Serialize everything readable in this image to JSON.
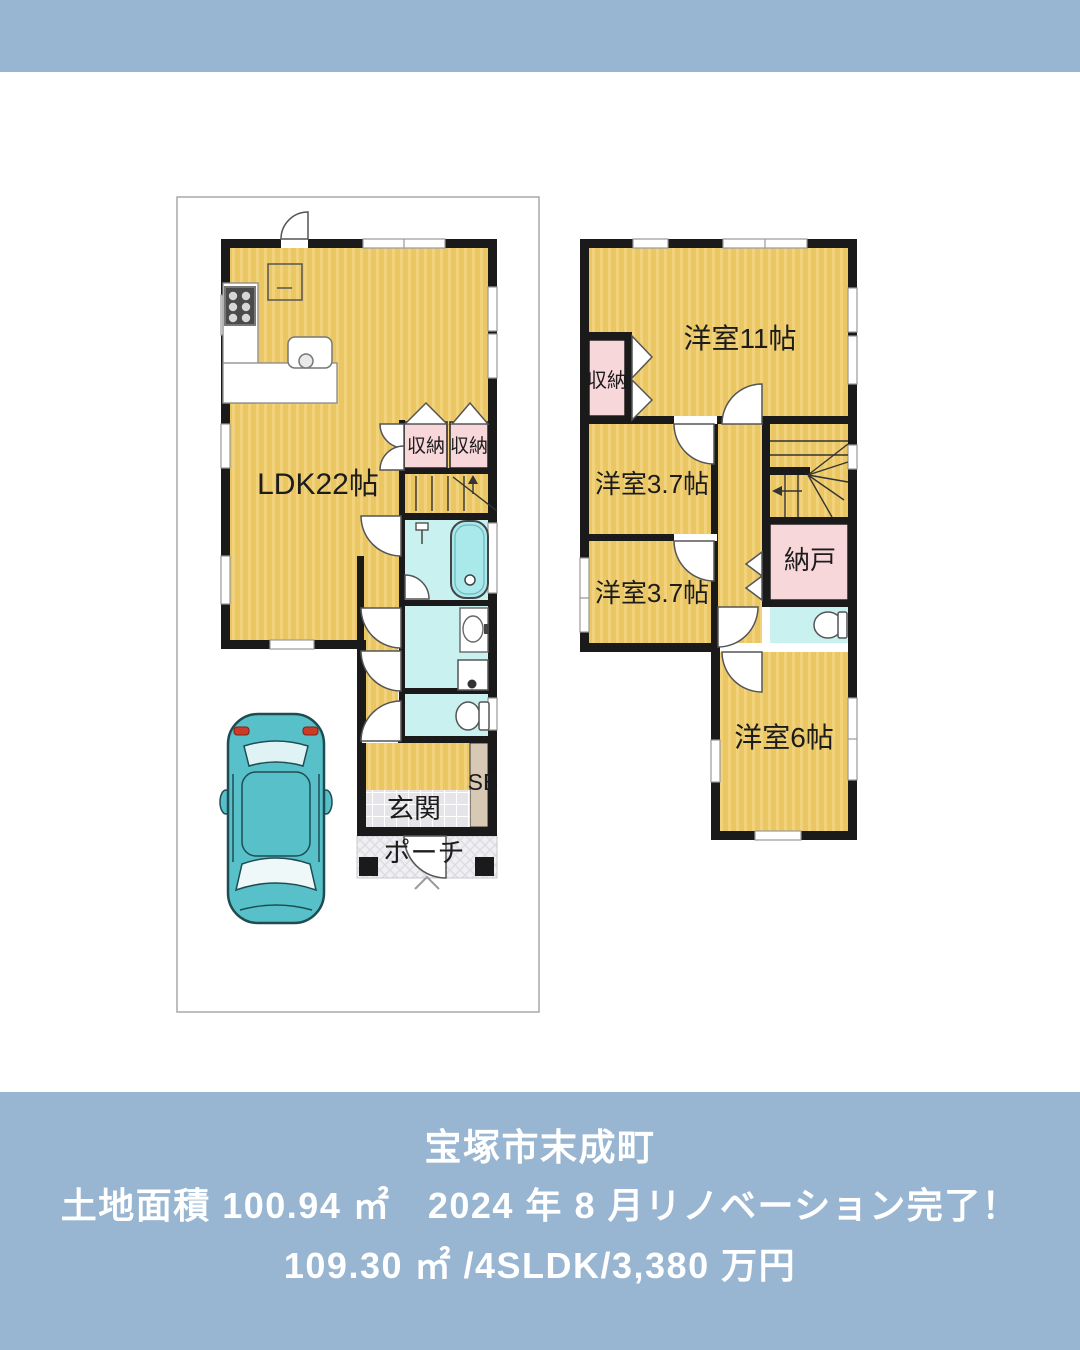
{
  "colors": {
    "banner_blue": "#98b5d2",
    "floor_yellow": "#ebc763",
    "floor_stripe": "#f2d37c",
    "closet_pink": "#f8d7da",
    "wet_area_cyan": "#c8f1ef",
    "tub_cyan": "#a9e9ec",
    "shoebox_tan": "#d8c9b4",
    "wall_black": "#1a1a1a",
    "car_teal": "#57c0c9"
  },
  "banner": {
    "title": "宝塚市末成町",
    "line2": "土地面積 100.94 ㎡　2024 年 8 月リノベーション完了！",
    "line3": "109.30 ㎡ /4SLDK/3,380 万円"
  },
  "floor1": {
    "ldk": "LDK22帖",
    "closet_a": "収納",
    "closet_b": "収納",
    "shoe_box": "SB",
    "entrance": "玄関",
    "porch": "ポーチ"
  },
  "floor2": {
    "room11": "洋室11帖",
    "closet": "収納",
    "room37_a": "洋室3.7帖",
    "room37_b": "洋室3.7帖",
    "storeroom": "納戸",
    "room6": "洋室6帖"
  }
}
